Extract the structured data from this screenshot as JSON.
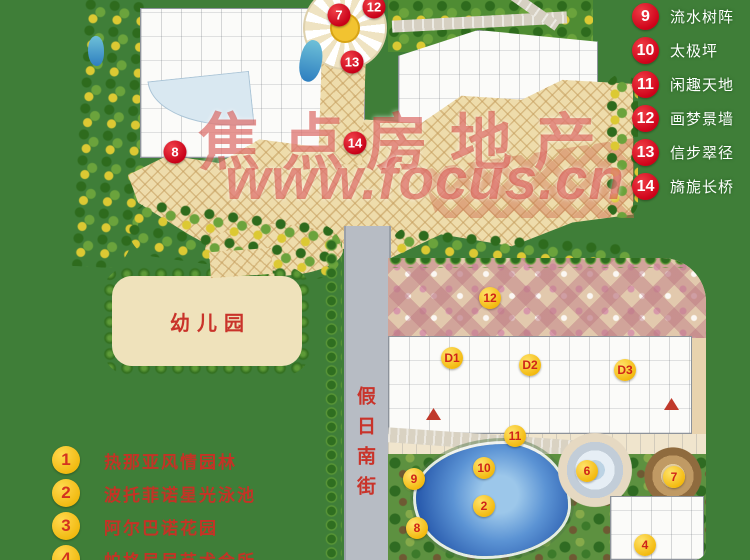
{
  "watermark": {
    "line1": "焦点房地产",
    "line2": "www.focus.cn"
  },
  "map": {
    "labels": {
      "kindergarten": "幼儿园",
      "street": "假日南街"
    },
    "markers": [
      {
        "n": "7",
        "x": 339,
        "y": 15,
        "type": "red"
      },
      {
        "n": "12",
        "x": 374,
        "y": 7,
        "type": "red"
      },
      {
        "n": "13",
        "x": 352,
        "y": 62,
        "type": "red"
      },
      {
        "n": "14",
        "x": 355,
        "y": 143,
        "type": "red"
      },
      {
        "n": "8",
        "x": 175,
        "y": 152,
        "type": "red"
      },
      {
        "n": "12",
        "x": 490,
        "y": 298,
        "type": "yellow"
      },
      {
        "n": "D1",
        "x": 452,
        "y": 358,
        "type": "yellow"
      },
      {
        "n": "D2",
        "x": 530,
        "y": 365,
        "type": "yellow"
      },
      {
        "n": "D3",
        "x": 625,
        "y": 370,
        "type": "yellow"
      },
      {
        "n": "11",
        "x": 515,
        "y": 436,
        "type": "yellow"
      },
      {
        "n": "10",
        "x": 484,
        "y": 468,
        "type": "yellow"
      },
      {
        "n": "9",
        "x": 414,
        "y": 479,
        "type": "yellow"
      },
      {
        "n": "6",
        "x": 587,
        "y": 471,
        "type": "yellow"
      },
      {
        "n": "7",
        "x": 674,
        "y": 477,
        "type": "yellow"
      },
      {
        "n": "2",
        "x": 484,
        "y": 506,
        "type": "yellow"
      },
      {
        "n": "8",
        "x": 417,
        "y": 528,
        "type": "yellow"
      },
      {
        "n": "4",
        "x": 645,
        "y": 545,
        "type": "yellow"
      }
    ]
  },
  "legend_right": {
    "items": [
      {
        "num": "9",
        "label": "流水树阵"
      },
      {
        "num": "10",
        "label": "太极坪"
      },
      {
        "num": "11",
        "label": "闲趣天地"
      },
      {
        "num": "12",
        "label": "画梦景墙"
      },
      {
        "num": "13",
        "label": "信步翠径"
      },
      {
        "num": "14",
        "label": "旖旎长桥"
      }
    ]
  },
  "legend_bottom_left": {
    "items": [
      {
        "num": "1",
        "label": "热那亚风情园林"
      },
      {
        "num": "2",
        "label": "波托菲诺星光泳池"
      },
      {
        "num": "3",
        "label": "阿尔巴诺花园"
      },
      {
        "num": "4",
        "label": "帕格尼尼艺术会所"
      }
    ]
  },
  "colors": {
    "grass": "#3f7e38",
    "legend_red": "#d2001e",
    "marker_yellow": "#f6c51c",
    "map_text_red": "#c9332a",
    "plaza_sand": "#eedcab",
    "road_gray": "#b7bcc4",
    "pool_blue": "#2a5cae"
  }
}
